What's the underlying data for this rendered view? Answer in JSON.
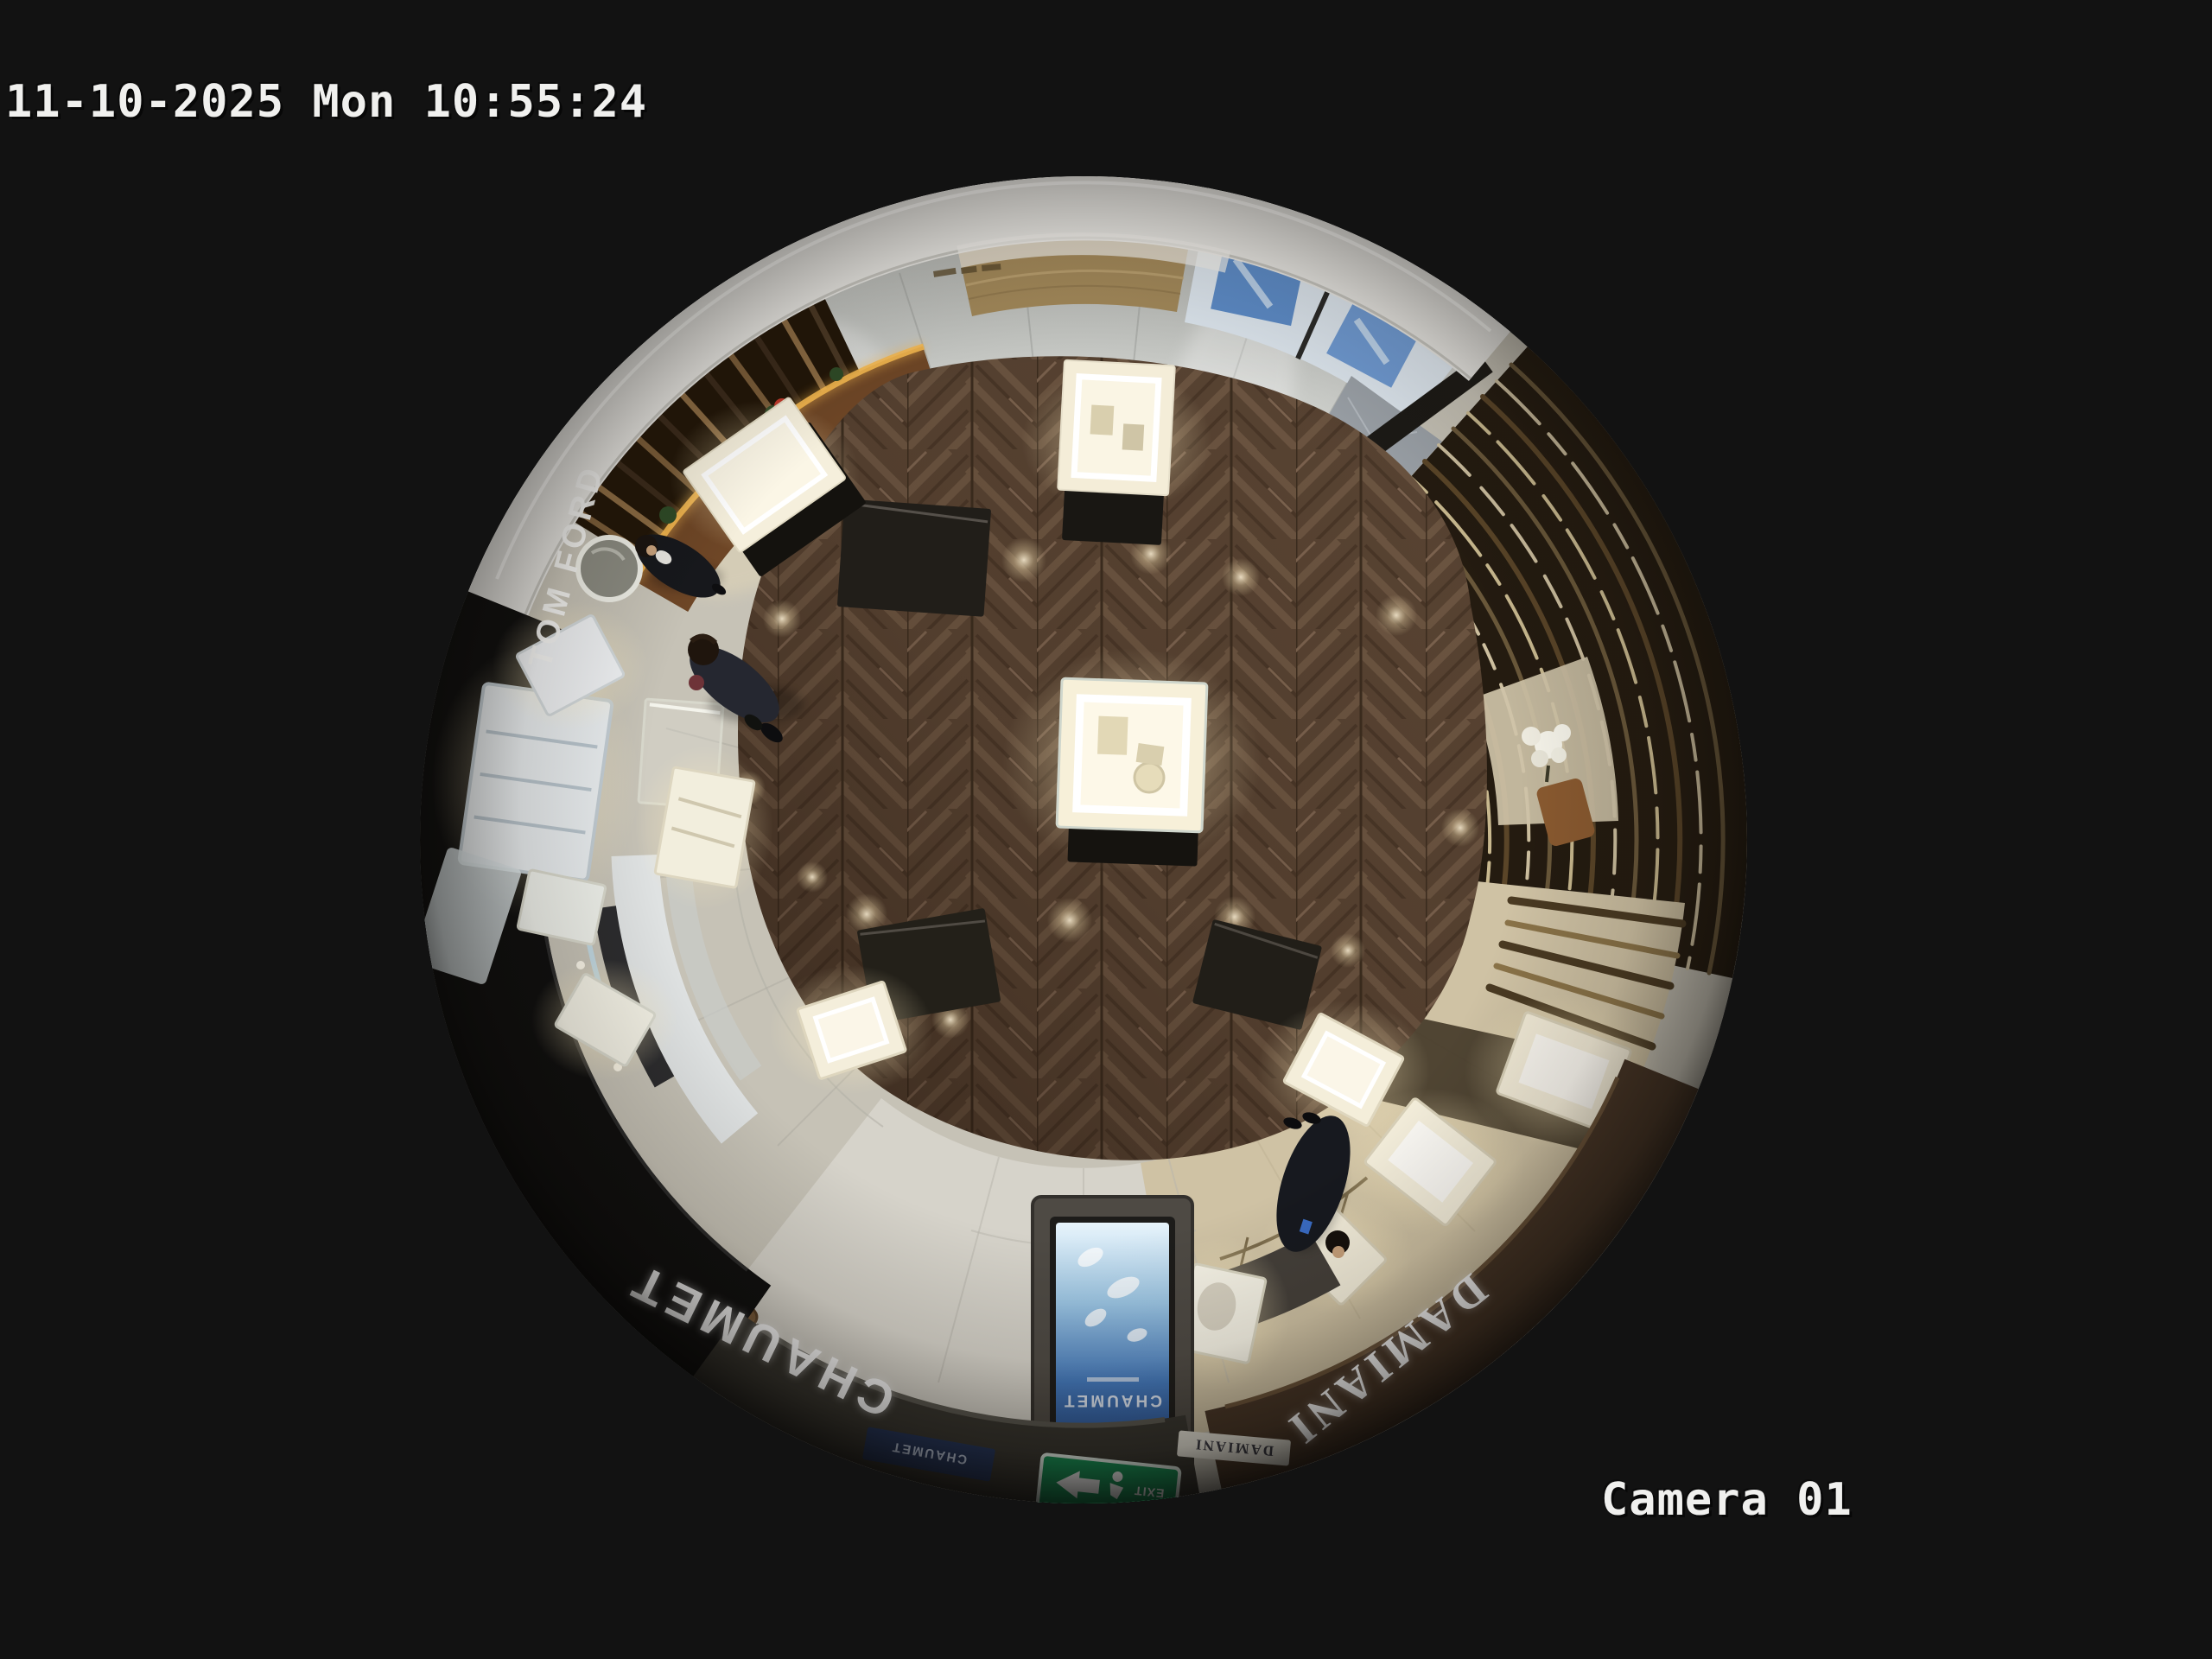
{
  "osd": {
    "timestamp": "11-10-2025 Mon 10:55:24",
    "camera_label": "Camera 01"
  },
  "scene": {
    "signs": {
      "tom_ford": "TOM FORD",
      "chaumet": "CHAUMET",
      "chaumet_kiosk": "CHAUMET",
      "chaumet_plaque": "CHAUMET",
      "damiani": "DAMIANI",
      "damiani_plaque": "DAMIANI",
      "exit": "EXIT"
    },
    "colors": {
      "background": "#121212",
      "osd_text": "#f0f0ee",
      "wood_floor": "#59422f",
      "marble": "#cfccc3",
      "gold_led": "#f5b84f",
      "exit_green": "#159356",
      "kiosk_screen_blue": "#2f5fa8",
      "chaumet_fascia": "#37352f",
      "damiani_fascia": "#473526",
      "tomford_storefront": "#0e0e0e"
    }
  }
}
